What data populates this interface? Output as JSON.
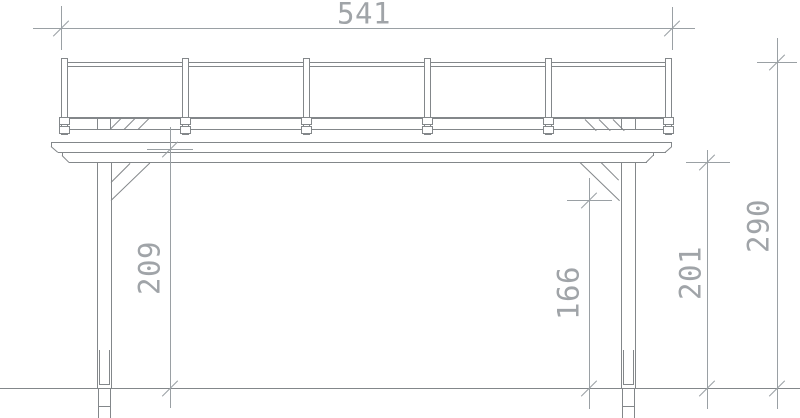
{
  "dimensions": {
    "overall_width": "541",
    "height_left": "209",
    "height_under_brace": "166",
    "height_right": "201",
    "height_total": "290"
  },
  "colors": {
    "structure_line": "#83878a",
    "dimension_line": "#9aa0a4",
    "background": "#ffffff"
  }
}
